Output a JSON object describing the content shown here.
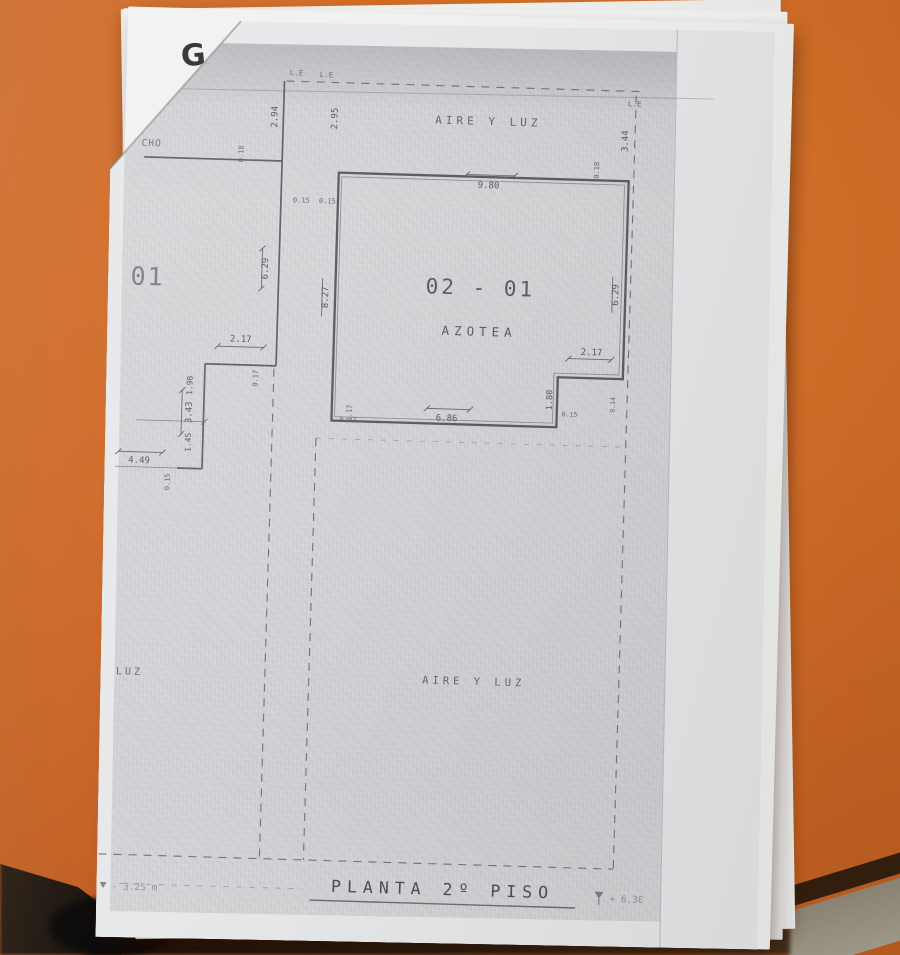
{
  "colors": {
    "table_orange": "#d16b26",
    "paper": "#e7e8ea",
    "print_gray": "#d5d6d8",
    "ink": "#56565a",
    "faded_ink": "#94949a"
  },
  "sheet": {
    "logo_letter": "G"
  },
  "plan": {
    "boundary": {
      "le1": "L.E",
      "le2": "L.E",
      "le3": "L.E"
    },
    "texts": {
      "aire_top": "AIRE Y LUZ",
      "room_no": "02 - 01",
      "room_name": "AZOTEA",
      "aire_bottom": "AIRE Y LUZ",
      "left_big": "01",
      "luz": "LUZ",
      "cho": "CHO"
    },
    "dims": {
      "d980": "9.80",
      "d294": "2.94",
      "d295": "2.95",
      "d344": "3.44",
      "d018a": "0.18",
      "d018b": "0.18",
      "d015a": "0.15",
      "d015b": "0.15",
      "d015c": "0.15",
      "d015d": "0.15",
      "d629l": "6.29",
      "d629r": "6.29",
      "d827": "8.27",
      "d217l": "2.17",
      "d217r": "2.17",
      "d217s": "2.17",
      "d017": "0.17",
      "d198": "1.98",
      "d343": "3.43",
      "d145": "1.45",
      "d449": "4.49",
      "d686": "6.86",
      "d077": "0.77",
      "d180": "1.80",
      "d014": "0.14"
    },
    "title": {
      "text": "PLANTA 2º PISO",
      "level_right": "+ 6.30 m",
      "level_left": "- 3.25 m"
    }
  }
}
